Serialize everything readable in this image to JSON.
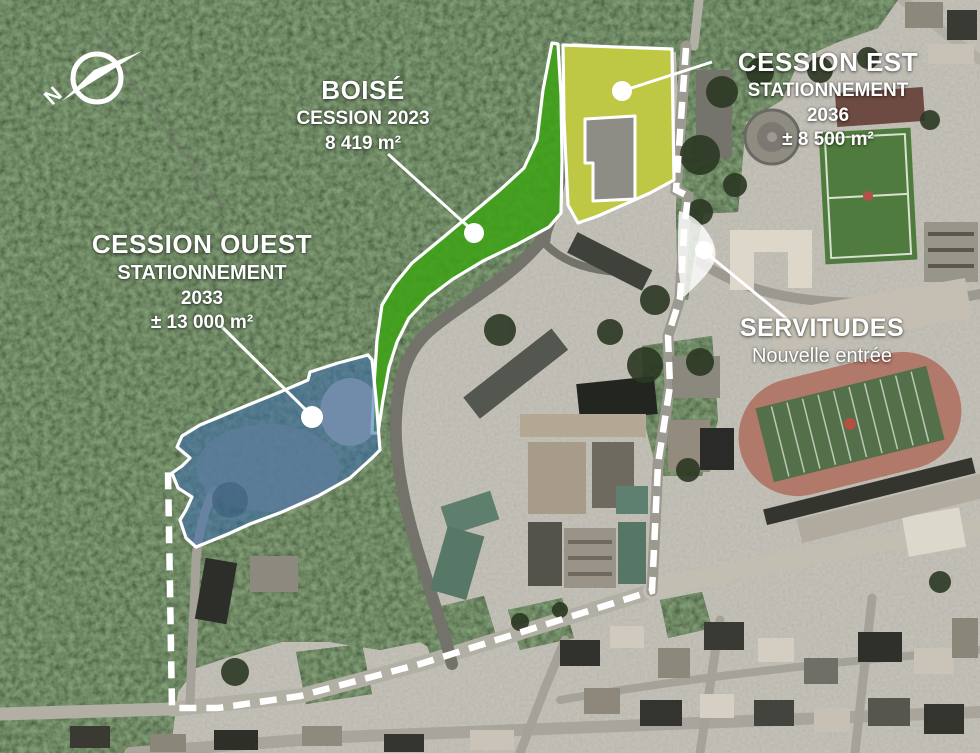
{
  "annotations": {
    "boise": {
      "title": "BOISÉ",
      "line1": "CESSION 2023",
      "line2": "8 419 m²"
    },
    "cession_est": {
      "title": "CESSION EST",
      "line1": "STATIONNEMENT",
      "line2": "2036",
      "line3": "± 8 500 m²"
    },
    "cession_ouest": {
      "title": "CESSION OUEST",
      "line1": "STATIONNEMENT",
      "line2": "2033",
      "line3": "± 13 000 m²"
    },
    "servitudes": {
      "title": "SERVITUDES",
      "line1": "Nouvelle entrée"
    },
    "compass": {
      "north": "N"
    }
  },
  "colors": {
    "boise_zone": "#3da315",
    "cession_est_zone": "#d8da3e",
    "cession_ouest_zone": "#3c6ca8",
    "servitudes_zone": "#ffffff",
    "boundary": "#ffffff"
  }
}
